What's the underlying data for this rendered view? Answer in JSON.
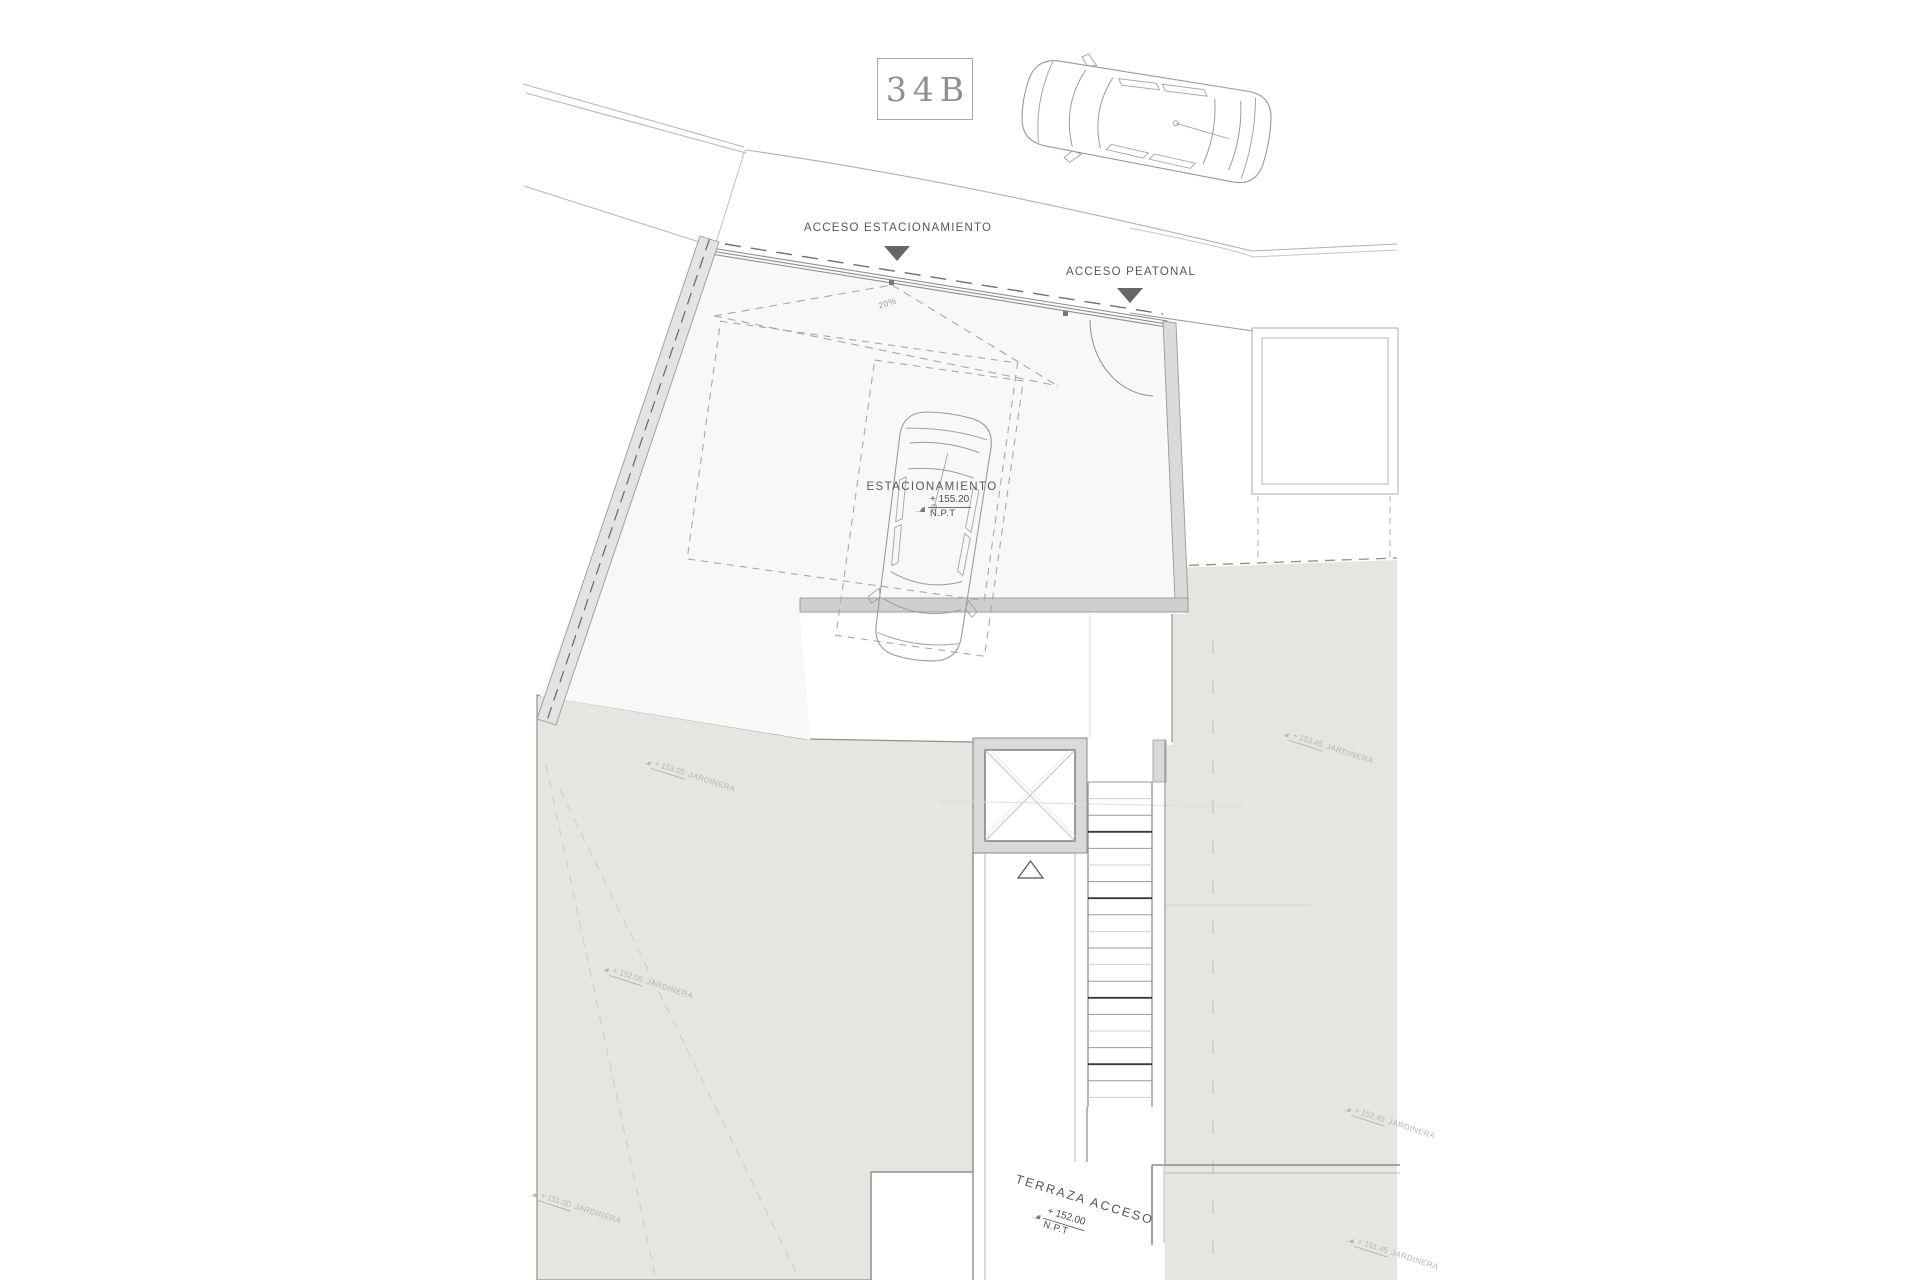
{
  "plan": {
    "number": "34B",
    "labels": {
      "parking_access": "ACCESO ESTACIONAMIENTO",
      "pedestrian_access": "ACCESO PEATONAL",
      "parking": "ESTACIONAMIENTO",
      "terrace_access": "TERRAZA ACCESO",
      "ramp_slope": "20%"
    },
    "levels": {
      "parking": {
        "value": "+ 155.20",
        "datum": "N.P.T"
      },
      "terrace": {
        "value": "+ 152.00",
        "datum": "N.P.T"
      }
    },
    "planters": [
      {
        "value": "+ 153.05",
        "label": "JARDINERA"
      },
      {
        "value": "+ 152.05",
        "label": "JARDINERA"
      },
      {
        "value": "+ 151.00",
        "label": "JARDINERA"
      },
      {
        "value": "+ 153.45",
        "label": "JARDINERA"
      },
      {
        "value": "+ 152.45",
        "label": "JARDINERA"
      },
      {
        "value": "+ 151.45",
        "label": "JARDINERA"
      }
    ],
    "colors": {
      "background": "#ffffff",
      "terrace": "#e4e6e0",
      "plot": "#f7f8f8",
      "wall_poche": "#dcdcdc",
      "line_dark": "#555555",
      "line_light": "#b0b0b0",
      "accent_arrow": "#666666",
      "faint_text": "#b4b7ae"
    }
  }
}
